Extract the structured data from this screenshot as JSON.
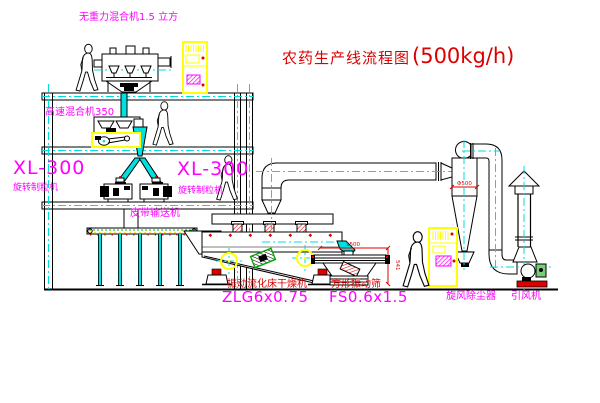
{
  "title": {
    "cn": "农药生产线流程图",
    "capacity": "(500kg/h)"
  },
  "labels": {
    "gravity_mixer": "无重力混合机1.5 立方",
    "high_speed_mixer": "高速混合机350",
    "granulator_left_model": "XL-300",
    "granulator_left_name": "旋转制粒机",
    "granulator_right_model": "XL-300",
    "granulator_right_name": "旋转制粒机",
    "belt_conveyor": "皮带输送机",
    "dryer_name": "振动流化床干燥机",
    "dryer_model": "ZLG6x0.75",
    "screen_name": "方形振动筛",
    "screen_model": "FS0.6x1.5",
    "cyclone": "旋风除尘器",
    "fan": "引风机"
  },
  "dimensions": {
    "screen_length": "1500",
    "screen_height": "541",
    "cyclone_dia": "Φ500"
  },
  "colors": {
    "label_magenta": "#FF00FF",
    "title_red": "#DE0000",
    "centerline_cyan": "#00DCDC",
    "cabinet_yellow": "#FFFF00",
    "line_black": "#000000"
  }
}
